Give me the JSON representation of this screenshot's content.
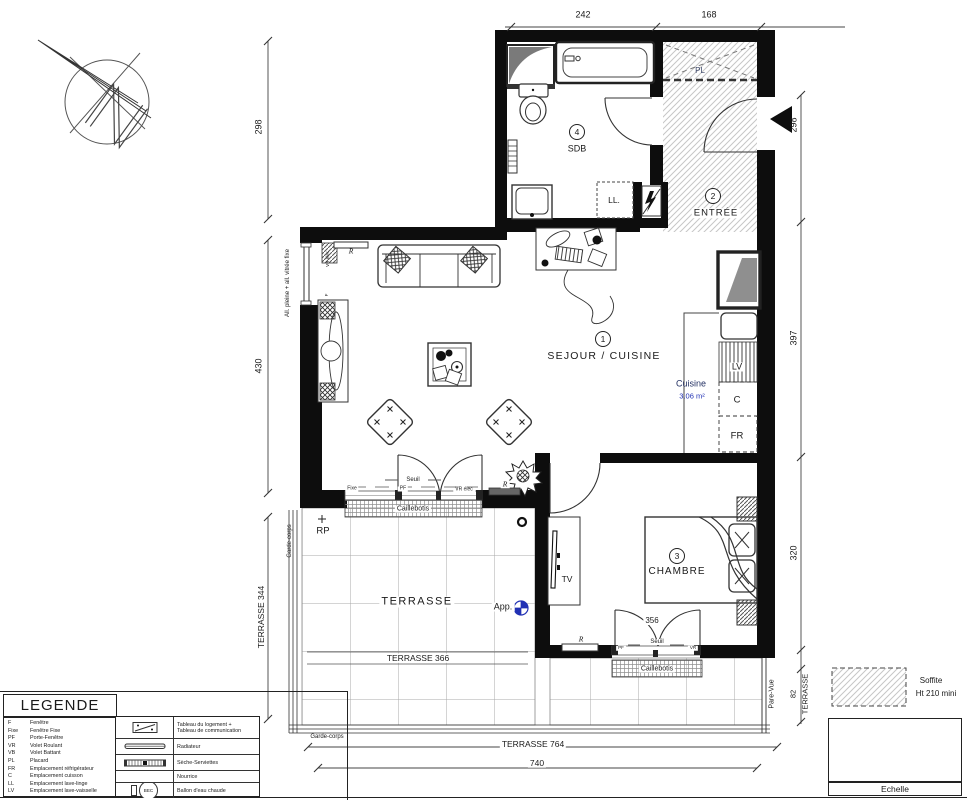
{
  "dims": {
    "top": [
      "242",
      "168"
    ],
    "left_upper": "298",
    "left_mid": "430",
    "left_terrace": "TERRASSE 344",
    "right_upper": "298",
    "right_mid": "397",
    "right_lower": "320",
    "right_terrace_h": "82",
    "right_terrace_label": "TERRASSE",
    "terrasse_764": "TERRASSE 764",
    "bottom_740": "740",
    "terrasse_366": "TERRASSE 366",
    "chambre_door": "356"
  },
  "rooms": {
    "sejour": {
      "num": "1",
      "label": "SEJOUR / CUISINE"
    },
    "entree": {
      "num": "2",
      "label": "ENTRÉE"
    },
    "chambre": {
      "num": "3",
      "label": "CHAMBRE"
    },
    "sdb": {
      "num": "4",
      "label": "SDB"
    },
    "cuisine": {
      "label": "Cuisine",
      "area": "3.06 m²"
    },
    "terrasse": {
      "label": "TERRASSE"
    }
  },
  "tags": {
    "pl": "PL",
    "ll": "LL.",
    "lv": "LV",
    "c": "C",
    "fr": "FR",
    "tv": "TV",
    "rp": "RP",
    "app": "App.",
    "radiator": "R"
  },
  "openings": {
    "sejour_bay": {
      "fixe": "Fixe",
      "pf": "PF",
      "vr": "VR élec",
      "seuil": "Seuil",
      "caillebotis": "Caillebotis"
    },
    "chambre_bay": {
      "pf": "PF",
      "vr": "VR",
      "seuil": "Seuil",
      "caillebotis": "Caillebotis"
    },
    "window_note": "All. pleine + all. vitrée fixe",
    "window_vr": "VR élec",
    "window_f": "F"
  },
  "edges": {
    "garde_corps": "Garde-corps",
    "pare_vue": "Pare-Vue"
  },
  "legend": {
    "title": "LEGENDE",
    "abbrev": [
      {
        "key": "F",
        "label": "Fenêtre"
      },
      {
        "key": "Fixe",
        "label": "Fenêtre Fixe"
      },
      {
        "key": "PF",
        "label": "Porte-Fenêtre"
      },
      {
        "key": "VR",
        "label": "Volet Roulant"
      },
      {
        "key": "VB",
        "label": "Volet Battant"
      },
      {
        "key": "PL",
        "label": "Placard"
      },
      {
        "key": "FR",
        "label": "Emplacement réfrigérateur"
      },
      {
        "key": "C",
        "label": "Emplacement cuisson"
      },
      {
        "key": "LL",
        "label": "Emplacement lave-linge"
      },
      {
        "key": "LV",
        "label": "Emplacement lave-vaisselle"
      }
    ],
    "symbols": [
      {
        "label": "Tableau du logement +",
        "label2": "Tableau de communication"
      },
      {
        "label": "Radiateur"
      },
      {
        "label": "Sèche-Serviettes"
      },
      {
        "label": "Nourrice"
      },
      {
        "label": "Ballon d'eau chaude",
        "bec": "BEC"
      }
    ]
  },
  "soffite": {
    "line1": "Soffite",
    "line2": "Ht 210 mini"
  },
  "scale_block": {
    "title": "Echelle",
    "ticks": [
      "0",
      "0,50",
      "1m",
      "2m"
    ]
  },
  "colors": {
    "accent_blue": "#2131b4",
    "label_navy": "#253264",
    "hatch_gray": "#c6c6c6"
  }
}
